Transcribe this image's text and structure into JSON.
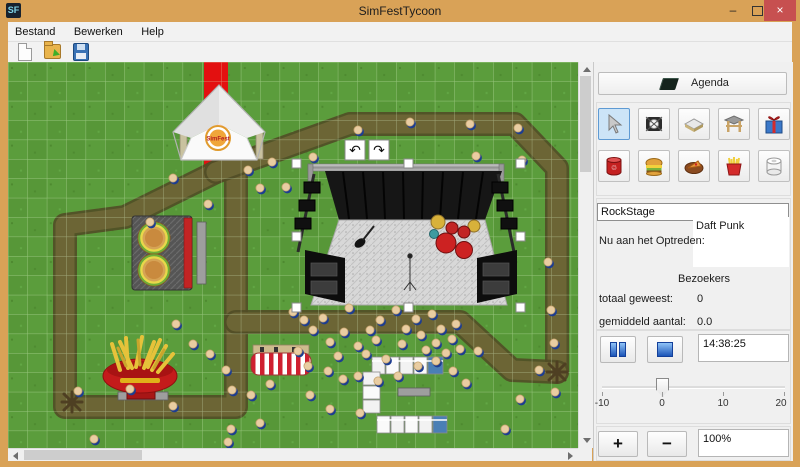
{
  "window": {
    "title": "SimFestTycoon",
    "icon_text": "SF",
    "minimize_glyph": "–",
    "close_glyph": "×"
  },
  "menu": {
    "items": [
      "Bestand",
      "Bewerken",
      "Help"
    ]
  },
  "panel": {
    "agenda_label": "Agenda",
    "stage_name": "RockStage",
    "now_performing_label": "Nu aan het Optreden:",
    "now_performing_value": "Daft Punk",
    "visitors_header": "Bezoekers",
    "total_label": "totaal geweest:",
    "total_value": "0",
    "average_label": "gemiddeld aantal:",
    "average_value": "0.0",
    "time_value": "14:38:25",
    "zoom_value": "100%",
    "zoom_in_label": "+",
    "zoom_out_label": "−",
    "slider": {
      "min": -10,
      "max": 20,
      "value": 0,
      "ticks": [
        "-10",
        "0",
        "10",
        "20"
      ]
    }
  },
  "colors": {
    "titlebar": "#d9a257",
    "close_button": "#c75050",
    "selected_tool": "#cce4f7",
    "grass": "#579738",
    "path": "#6c6535",
    "carpet": "#e31010"
  },
  "map": {
    "tent_logo_text": "SimFest",
    "rotate_left_glyph": "↶",
    "rotate_right_glyph": "↷",
    "paths": [
      [
        [
          208,
          110
        ],
        [
          117,
          155
        ],
        [
          57,
          163
        ],
        [
          57,
          345
        ],
        [
          228,
          345
        ],
        [
          228,
          112
        ]
      ],
      [
        [
          208,
          110
        ],
        [
          342,
          62
        ],
        [
          507,
          62
        ],
        [
          549,
          106
        ],
        [
          549,
          310
        ]
      ],
      [
        [
          228,
          260
        ],
        [
          452,
          260
        ],
        [
          504,
          308
        ],
        [
          549,
          310
        ]
      ]
    ],
    "people": [
      [
        165,
        116
      ],
      [
        240,
        108
      ],
      [
        252,
        126
      ],
      [
        264,
        100
      ],
      [
        278,
        125
      ],
      [
        200,
        142
      ],
      [
        142,
        160
      ],
      [
        305,
        95
      ],
      [
        350,
        68
      ],
      [
        402,
        60
      ],
      [
        462,
        62
      ],
      [
        510,
        66
      ],
      [
        514,
        98
      ],
      [
        468,
        94
      ],
      [
        540,
        200
      ],
      [
        543,
        248
      ],
      [
        546,
        281
      ],
      [
        531,
        308
      ],
      [
        547,
        330
      ],
      [
        285,
        250
      ],
      [
        296,
        258
      ],
      [
        305,
        268
      ],
      [
        315,
        256
      ],
      [
        322,
        280
      ],
      [
        330,
        294
      ],
      [
        336,
        270
      ],
      [
        341,
        246
      ],
      [
        350,
        284
      ],
      [
        358,
        292
      ],
      [
        362,
        268
      ],
      [
        368,
        278
      ],
      [
        372,
        258
      ],
      [
        378,
        297
      ],
      [
        388,
        248
      ],
      [
        394,
        282
      ],
      [
        398,
        267
      ],
      [
        408,
        257
      ],
      [
        413,
        273
      ],
      [
        418,
        288
      ],
      [
        424,
        252
      ],
      [
        428,
        281
      ],
      [
        433,
        267
      ],
      [
        438,
        291
      ],
      [
        444,
        277
      ],
      [
        448,
        262
      ],
      [
        452,
        287
      ],
      [
        410,
        304
      ],
      [
        390,
        314
      ],
      [
        370,
        319
      ],
      [
        350,
        314
      ],
      [
        335,
        317
      ],
      [
        320,
        309
      ],
      [
        300,
        304
      ],
      [
        290,
        289
      ],
      [
        168,
        262
      ],
      [
        185,
        282
      ],
      [
        202,
        292
      ],
      [
        218,
        308
      ],
      [
        224,
        328
      ],
      [
        243,
        333
      ],
      [
        262,
        322
      ],
      [
        302,
        333
      ],
      [
        322,
        347
      ],
      [
        352,
        351
      ],
      [
        223,
        367
      ],
      [
        252,
        361
      ],
      [
        497,
        367
      ],
      [
        512,
        337
      ],
      [
        86,
        377
      ],
      [
        122,
        327
      ],
      [
        165,
        344
      ],
      [
        70,
        329
      ],
      [
        428,
        299
      ],
      [
        445,
        309
      ],
      [
        458,
        321
      ],
      [
        470,
        289
      ],
      [
        220,
        380
      ]
    ],
    "markers": [
      [
        549,
        310
      ],
      [
        64,
        340
      ]
    ],
    "benches": [
      [
        110,
        330,
        50,
        8
      ],
      [
        189,
        160,
        9,
        62
      ],
      [
        390,
        326,
        32,
        8
      ]
    ]
  }
}
